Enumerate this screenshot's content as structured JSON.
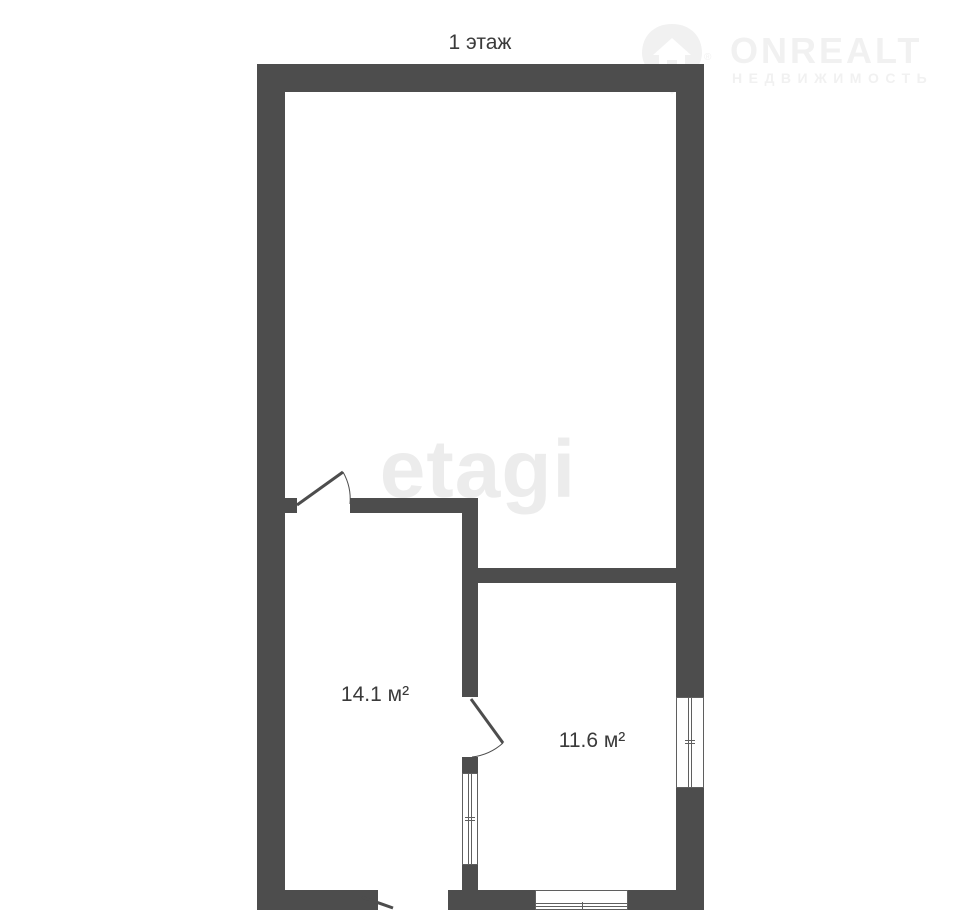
{
  "page": {
    "title": "1 этаж"
  },
  "floor_plan": {
    "floor_label": "1 этаж",
    "rooms": [
      {
        "name": "room-14-1",
        "area_label": "14.1 м²"
      },
      {
        "name": "room-11-6",
        "area_label": "11.6 м²"
      }
    ]
  },
  "watermarks": {
    "center_text": "etagi",
    "logo": {
      "brand": "ONREALT",
      "subtitle": "НЕДВИЖИМОСТЬ",
      "registered_mark": "®",
      "icon": "house-pin-icon"
    }
  },
  "colors": {
    "wall": "#4d4d4d",
    "text": "#3a3a3a",
    "watermark": "#ececec",
    "logo_watermark": "#f1f1f1",
    "window_line": "#5f5f5f",
    "background": "#ffffff"
  }
}
